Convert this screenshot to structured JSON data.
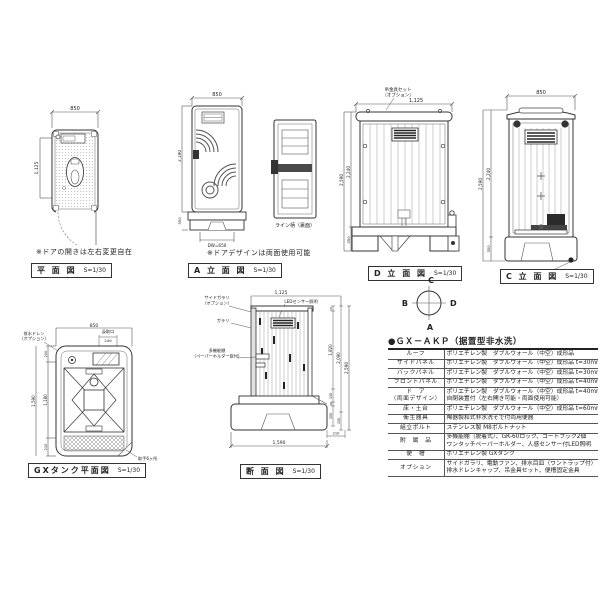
{
  "views": {
    "plan": {
      "title": "平 面 図",
      "scale": "S=1/30",
      "note": "※ドアの開きは左右変更自在",
      "dims": {
        "width": "850",
        "depth": "1,125"
      }
    },
    "elev_a": {
      "title": "A 立 面 図",
      "scale": "S=1/30",
      "note": "※ドアデザインは両面使用可能",
      "panel_label": "ライン柄（裏面）",
      "dims": {
        "width": "850",
        "height": "2,190",
        "base": "350",
        "door": "DW=650"
      }
    },
    "elev_d": {
      "title": "D 立 面 図",
      "scale": "S=1/30",
      "hook_label": [
        "吊金具セット",
        "（オプション）"
      ],
      "dims": {
        "width": "1,125",
        "total": "2,590",
        "body": "2,240",
        "base": "350"
      }
    },
    "elev_c": {
      "title": "C 立 面 図",
      "scale": "S=1/30",
      "drain_label": [
        "排水ドレン",
        "（オプション）"
      ],
      "dims": {
        "width": "850",
        "total": "2,590",
        "body": "2,240",
        "base": "350"
      }
    },
    "tank": {
      "title": "GXタンク平面図",
      "scale": "S=1/30",
      "drain_label": [
        "排水ドレン",
        "（オプション）"
      ],
      "port_label": "汲取口",
      "handle_label": "取手6ヶ所",
      "dims": {
        "width": "850",
        "port": "240",
        "top": "200",
        "mid": "1,180",
        "bottom": "210",
        "total": "1,590"
      }
    },
    "section": {
      "title": "断 面 図",
      "scale": "S=1/30",
      "labels": {
        "side_louver": [
          "サイドガラリ",
          "（オプション）"
        ],
        "louver": "ガラリ",
        "shelf": [
          "多機能棚",
          "（ペーパーホルダー取付）"
        ],
        "led": "LEDセンサー照明"
      },
      "dims": {
        "depth_top": "1,125",
        "roof": "50",
        "interior": "1,820",
        "opening": "2,090",
        "total": "2,590",
        "d130": "130",
        "d40": "40",
        "d200": "200",
        "d150": "150",
        "base_offset": "210",
        "base_depth": "1,590"
      }
    }
  },
  "compass": {
    "top": "C",
    "left": "B",
    "right": "D",
    "bottom": "A"
  },
  "spec_table": {
    "title": "●ＧＸ－ＡＫＰ（据置型非水洗）",
    "rows": [
      {
        "label": [
          "ルーフ"
        ],
        "value": [
          "ポリエチレン製　ダブルウォール（中空）成形品"
        ]
      },
      {
        "label": [
          "サイドパネル"
        ],
        "value": [
          "ポリエチレン製　ダブルウォール（中空）成形品 t=30mm"
        ]
      },
      {
        "label": [
          "バックパネル"
        ],
        "value": [
          "ポリエチレン製　ダブルウォール（中空）成形品 t=30mm"
        ]
      },
      {
        "label": [
          "フロントパネル"
        ],
        "value": [
          "ポリエチレン製　ダブルウォール（中空）成形品 t=40mm"
        ]
      },
      {
        "label": [
          "ド　ア",
          "（両面デザイン）"
        ],
        "value": [
          "ポリエチレン製　ダブルウォール（中空）成形品 t=40mm",
          "自閉装置付（左右開き可能・両面使用可能）"
        ]
      },
      {
        "label": [
          "床・土台"
        ],
        "value": [
          "ポリエチレン製　ダブルウォール（中空）成形品 t=60mm"
        ]
      },
      {
        "label": [
          "衛生器具"
        ],
        "value": [
          "陶器製和式非水洗そで付両用便器"
        ]
      },
      {
        "label": [
          "組立ボルト"
        ],
        "value": [
          "ステンレス製 M8ボルトナット"
        ]
      },
      {
        "label": [
          "附　属　品"
        ],
        "value": [
          "多機能棚（脱着式）、GR-60ロック、コートフック2個",
          "ワンタッチペーパーホルダー、人感センサー付LED照明"
        ]
      },
      {
        "label": [
          "便　槽"
        ],
        "value": [
          "ポリエチレン製 GXタンク"
        ]
      },
      {
        "label": [
          "オプション"
        ],
        "value": [
          "サイドガラリ、電動ファン、排水目皿（ワントラップ付）",
          "排水ドレンキャップ、吊金具セット、便槽固定金具"
        ]
      }
    ]
  }
}
